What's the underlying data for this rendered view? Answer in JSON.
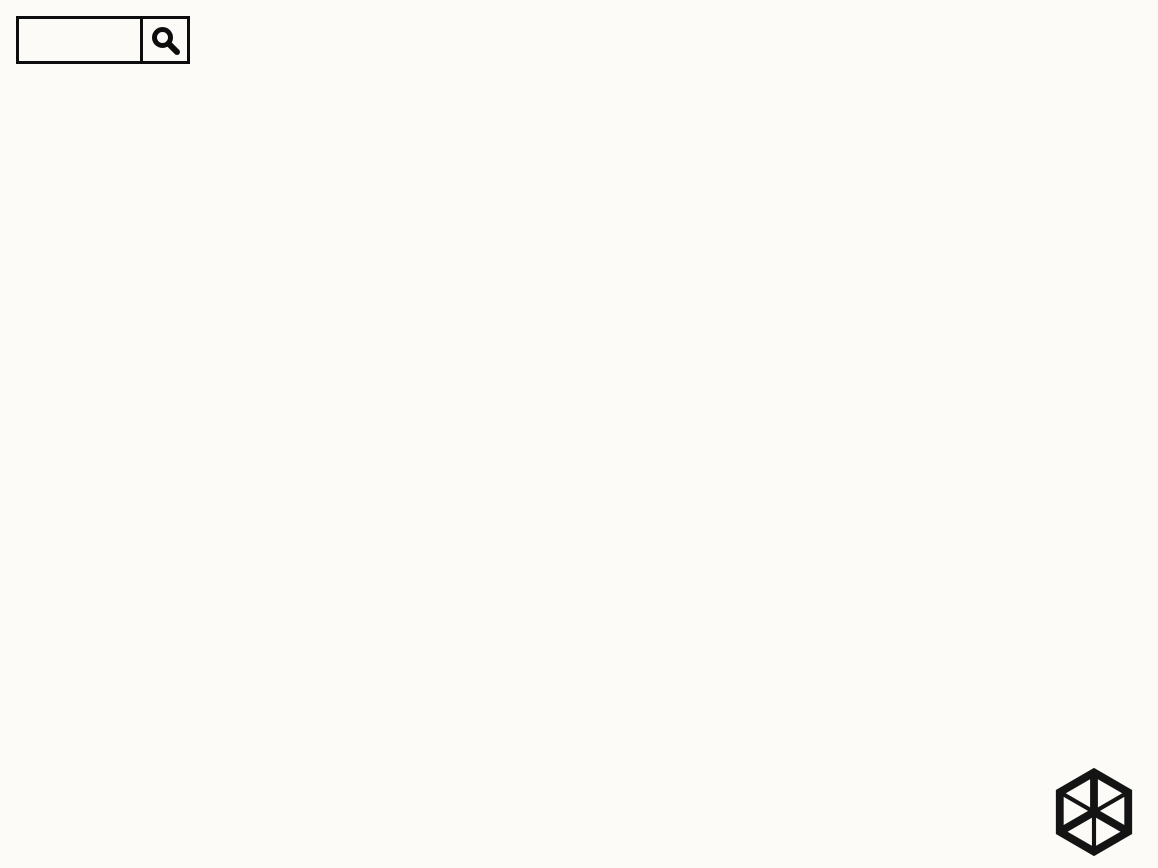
{
  "header": {
    "tagline": "更多装修资讯敬请搜索",
    "brand": "锦华装饰",
    "search_icon": "magnifier"
  },
  "footer": {
    "brand": "锦华装饰",
    "subtitle": "设计专家",
    "website": "WWW.JHZS.COM",
    "logo_icon": "isometric-cube"
  },
  "illustration": {
    "type": "3d-isometric-apartment-cutaway",
    "rooms": [
      "living-room",
      "dining-area",
      "kitchen",
      "entry",
      "bedroom-1",
      "bedroom-2",
      "kids-room",
      "bathroom-a",
      "bathroom-b",
      "master-bedroom",
      "hallway"
    ]
  },
  "palette": {
    "background": "#fcfbf7",
    "wall_white": "#f8f7f3",
    "wall_shade": "#e2e0d9",
    "wall_light": "#efeee8",
    "floor_tile": "#ddd6c2",
    "floor_kitchen": "#d9d0b6",
    "floor_wood": "#e8ddc2",
    "floor_kids": "#ecd8ae",
    "floor_marble": "#f0eadd",
    "wood_dark": "#4a2c17",
    "wood_mid": "#63391d",
    "wood_red": "#71381f",
    "art_teal": "#2f958c",
    "gold": "#caa45c",
    "sofa_cream": "#f1ecdc",
    "chair_blue": "#2f78cc",
    "pillow_yellow": "#f0b12c",
    "pillow_blue": "#3f6fc0",
    "rug_gray": "#d6d3cb",
    "rug_dark": "#5e5e5c",
    "balcony_rug_blue": "#5b87b5",
    "ink": "#0d0d0d"
  }
}
